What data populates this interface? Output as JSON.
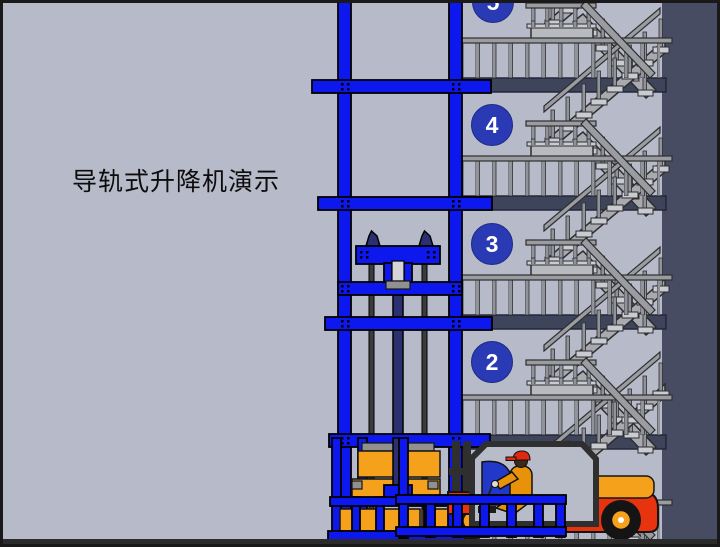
{
  "scene": {
    "title": {
      "text": "导轨式升降机演示"
    },
    "floors": [
      {
        "label": "5"
      },
      {
        "label": "4"
      },
      {
        "label": "3"
      },
      {
        "label": "2"
      }
    ],
    "colors": {
      "background": "#b6bac9",
      "right_wall": "#474c63",
      "floor_slab": "#3e4459",
      "ground": "#2b2b2b",
      "lift_frame_blue": "#0d18ee",
      "hydraulic_ram_navy": "#2b3170",
      "floor_badge_blue": "#2a3ab5",
      "badge_text": "#ffffff",
      "cargo_orange": "#f5a11c",
      "forklift_body_red": "#e8330f",
      "driver_suit_orange": "#e8920a",
      "driver_cap_red": "#e02810",
      "driver_seat_blue": "#2238c8",
      "stair_rail_gray": "#9a9ca2"
    }
  }
}
